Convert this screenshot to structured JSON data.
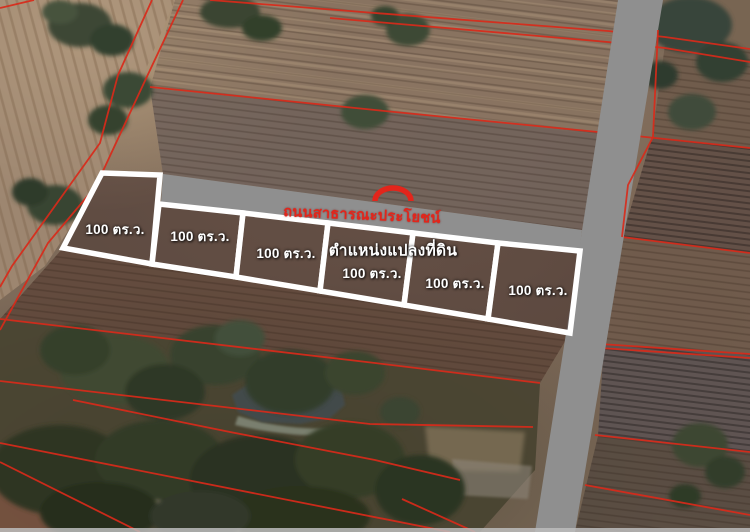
{
  "map": {
    "type": "satellite-photo-with-land-plot-overlay",
    "plots": {
      "items": [
        {
          "id": 1,
          "label": "100 ตร.ว."
        },
        {
          "id": 2,
          "label": "100 ตร.ว."
        },
        {
          "id": 3,
          "label": "100 ตร.ว."
        },
        {
          "id": 4,
          "label": "100 ตร.ว."
        },
        {
          "id": 5,
          "label": "100 ตร.ว."
        },
        {
          "id": 6,
          "label": "100 ตร.ว."
        }
      ]
    },
    "road_label": {
      "text": "ถนนสาธารณะประโยชน์"
    },
    "position_label": {
      "text": "ตำแหน่งแปลงที่ดิน"
    },
    "colors": {
      "road_gray": "#8f8f8f",
      "plot_outline_white": "#ffffff",
      "cadastral_red": "#d92a1a",
      "road_label_red": "#e3251b",
      "plot_label_white": "#ffffff"
    }
  }
}
